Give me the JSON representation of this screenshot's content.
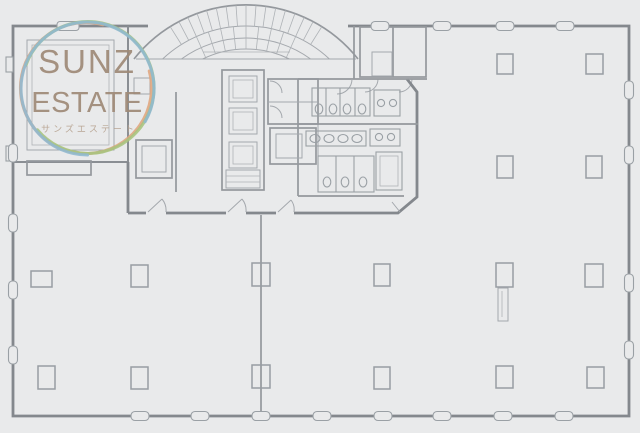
{
  "logo": {
    "line1": "SUNZ",
    "line2": "ESTATE",
    "subtitle": "サンズエステート",
    "text_color": "#9f8a77",
    "subtitle_color": "#b5a08d",
    "ring_colors": {
      "orange": "#dfa57e",
      "green": "#a6c47e",
      "blue": "#8fb8d0"
    }
  },
  "plan_colors": {
    "background": "#e9eaeb",
    "outer_wall": "#84888d",
    "inner_line": "#9aa0a5"
  }
}
